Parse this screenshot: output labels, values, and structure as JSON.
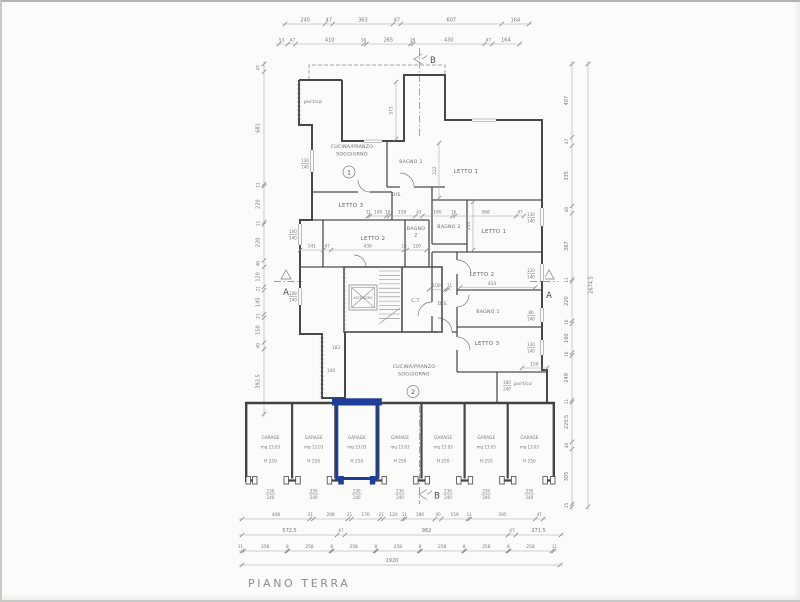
{
  "page": {
    "title": "PIANO TERRA"
  },
  "markers": {
    "section_a": "A",
    "section_b": "B"
  },
  "units": {
    "apartment_1": "1",
    "apartment_2": "2"
  },
  "rooms": {
    "portico_top": "portico",
    "portico_bottom": "portico",
    "cucina_l1": "CUCINA/PRANZO",
    "cucina_l2": "SOGGIORNO",
    "bagno1": "BAGNO 1",
    "bagno2": "BAGNO 2",
    "bagno2_l1": "BAGNO",
    "bagno2_l2": "2",
    "letto1": "LETTO 1",
    "letto2": "LETTO 2",
    "letto3": "LETTO 3",
    "dis": "DIS.",
    "ct": "C.T.",
    "ascensore": "ASCENSORE"
  },
  "garage": {
    "label": "GARAGE",
    "area": "mq 13.03",
    "height": "H 250",
    "door_width": "230",
    "door_height": "240",
    "count": 7,
    "highlighted_bay": 3,
    "highlight_color": "#1e3c99"
  },
  "dims": {
    "top1": [
      "240",
      "47",
      "363",
      "47",
      "607",
      "164"
    ],
    "top2": [
      "53",
      "47",
      "410",
      "16",
      "265",
      "16",
      "430",
      "47",
      "164"
    ],
    "left": [
      "47",
      "681",
      "11",
      "220",
      "11",
      "220",
      "40",
      "120",
      "21",
      "145",
      "21",
      "150",
      "40",
      "392.5"
    ],
    "right": [
      "407",
      "47",
      "335",
      "40",
      "367",
      "11",
      "220",
      "16",
      "160",
      "16",
      "249",
      "11",
      "220.5",
      "40",
      "305",
      "15"
    ],
    "right_total": "2674.5",
    "bottom1": [
      "408",
      "21",
      "208",
      "21",
      "170",
      "21",
      "120",
      "11",
      "180",
      "40",
      "159",
      "11",
      "395",
      "47"
    ],
    "bottom2": [
      "572.5",
      "47",
      "982",
      "47",
      "271.5"
    ],
    "bottom3": [
      "11",
      "258",
      "8",
      "258",
      "8",
      "258",
      "8",
      "258",
      "8",
      "258",
      "8",
      "258",
      "8",
      "258",
      "11"
    ],
    "bottom_total": "1920",
    "interior": {
      "notch_height": "373",
      "bagno_height": "222",
      "letto1_height": "254",
      "letto2b_width": "454",
      "mid_row": [
        "11",
        "100",
        "16",
        "158",
        "43",
        "180",
        "16",
        "368",
        "47"
      ],
      "letto2_row": [
        "141",
        "47",
        "439",
        "16",
        "120"
      ],
      "dis_row": [
        "100",
        "11"
      ],
      "portico_width": "150",
      "recess_a": "183",
      "recess_b": "140"
    },
    "windows": [
      [
        "130",
        "140"
      ],
      [
        "100",
        "140"
      ],
      [
        "108",
        "140"
      ],
      [
        "130",
        "140"
      ],
      [
        "120",
        "140"
      ],
      [
        "80",
        "140"
      ],
      [
        "130",
        "140"
      ],
      [
        "180",
        "240"
      ]
    ]
  }
}
